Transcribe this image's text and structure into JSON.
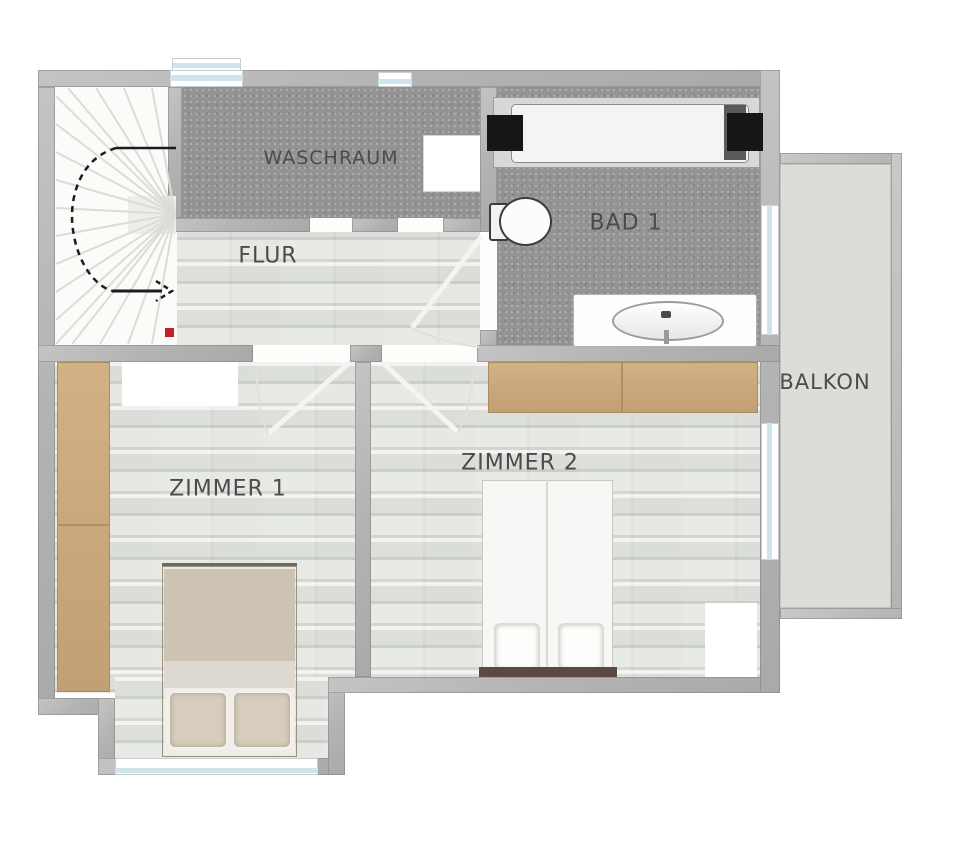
{
  "plan": {
    "type": "floor-plan",
    "rooms": {
      "waschraum": {
        "label": "WASCHRAUM"
      },
      "flur": {
        "label": "FLUR"
      },
      "bad1": {
        "label": "BAD 1"
      },
      "zimmer1": {
        "label": "ZIMMER 1"
      },
      "zimmer2": {
        "label": "ZIMMER 2"
      },
      "balkon": {
        "label": "BALKON"
      }
    },
    "icons": {
      "stair_direction_arrow": "curved-dashed-arrow",
      "stair_marker": "red-square"
    },
    "colors": {
      "wall": "#b2b2b2",
      "tile_floor": "#939393",
      "wood_floor": "#e2e3df",
      "furniture_wood": "#c9a87d",
      "window_glass": "#cfe4ec",
      "balcony_floor": "#dcdcd8",
      "stair_marker": "#c32222",
      "bed2_headboard": "#5a4a41",
      "label_text": "#4b4b4b"
    }
  }
}
